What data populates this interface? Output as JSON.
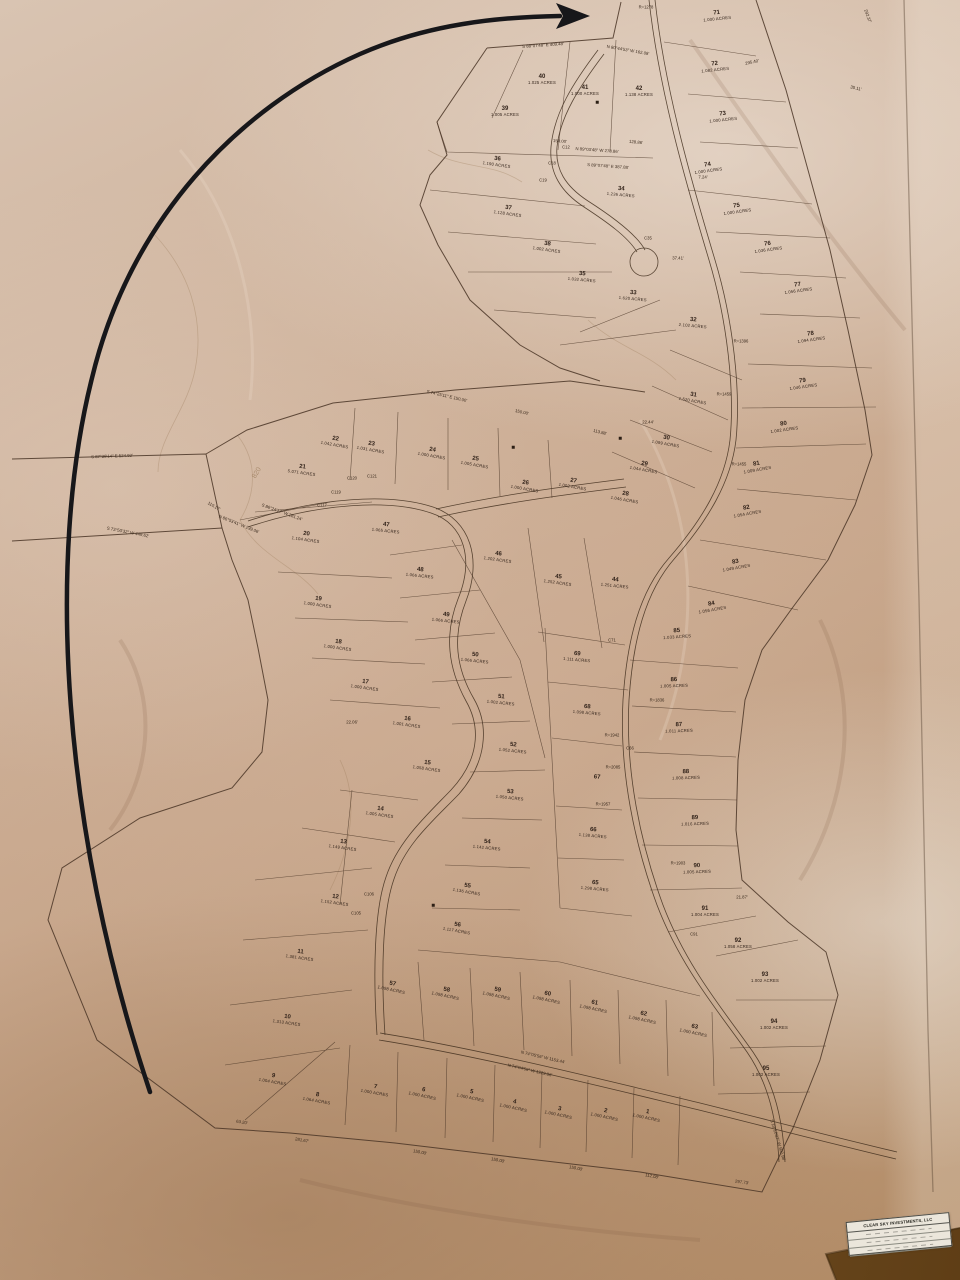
{
  "title_block": {
    "company": "CLEAR SKY INVESTMENTS, LLC",
    "rows": [
      "",
      "",
      ""
    ]
  },
  "colors": {
    "paper": "#cbab90",
    "table_wood": "#6d4a22",
    "plat_ink": "#3a2a1d",
    "hand_arrow": "#17171a"
  },
  "lots": [
    {
      "n": "1",
      "a": "1.000 ACRES",
      "x": 647,
      "y": 1115,
      "r": 12
    },
    {
      "n": "2",
      "a": "1.000 ACRES",
      "x": 605,
      "y": 1114,
      "r": 12
    },
    {
      "n": "3",
      "a": "1.000 ACRES",
      "x": 559,
      "y": 1112,
      "r": 12
    },
    {
      "n": "4",
      "a": "1.000 ACRES",
      "x": 514,
      "y": 1105,
      "r": 12
    },
    {
      "n": "5",
      "a": "1.000 ACRES",
      "x": 471,
      "y": 1095,
      "r": 12
    },
    {
      "n": "6",
      "a": "1.000 ACRES",
      "x": 423,
      "y": 1093,
      "r": 12
    },
    {
      "n": "7",
      "a": "1.000 ACRES",
      "x": 375,
      "y": 1090,
      "r": 10
    },
    {
      "n": "8",
      "a": "1.064 ACRES",
      "x": 317,
      "y": 1098,
      "r": 10
    },
    {
      "n": "9",
      "a": "1.004 ACRES",
      "x": 273,
      "y": 1079,
      "r": 10
    },
    {
      "n": "10",
      "a": "1.313 ACRES",
      "x": 287,
      "y": 1020,
      "r": 8
    },
    {
      "n": "11",
      "a": "1.381 ACRES",
      "x": 300,
      "y": 955,
      "r": 8
    },
    {
      "n": "12",
      "a": "1.152 ACRES",
      "x": 335,
      "y": 900,
      "r": 8
    },
    {
      "n": "13",
      "a": "1.149 ACRES",
      "x": 343,
      "y": 845,
      "r": 8
    },
    {
      "n": "14",
      "a": "1.005 ACRES",
      "x": 380,
      "y": 812,
      "r": 8
    },
    {
      "n": "15",
      "a": "1.058 ACRES",
      "x": 427,
      "y": 766,
      "r": 8
    },
    {
      "n": "16",
      "a": "1.001 ACRES",
      "x": 407,
      "y": 722,
      "r": 8
    },
    {
      "n": "17",
      "a": "1.000 ACRES",
      "x": 365,
      "y": 685,
      "r": 8
    },
    {
      "n": "18",
      "a": "1.000 ACRES",
      "x": 338,
      "y": 645,
      "r": 8
    },
    {
      "n": "19",
      "a": "1.000 ACRES",
      "x": 318,
      "y": 602,
      "r": 8
    },
    {
      "n": "20",
      "a": "1.104 ACRES",
      "x": 306,
      "y": 537,
      "r": 8
    },
    {
      "n": "21",
      "a": "5.071 ACRES",
      "x": 302,
      "y": 470,
      "r": 8
    },
    {
      "n": "22",
      "a": "1.042 ACRES",
      "x": 335,
      "y": 442,
      "r": 10
    },
    {
      "n": "23",
      "a": "1.031 ACRES",
      "x": 371,
      "y": 447,
      "r": 10
    },
    {
      "n": "24",
      "a": "1.000 ACRES",
      "x": 432,
      "y": 453,
      "r": 10
    },
    {
      "n": "25",
      "a": "1.005 ACRES",
      "x": 475,
      "y": 462,
      "r": 10
    },
    {
      "n": "26",
      "a": "1.000 ACRES",
      "x": 525,
      "y": 486,
      "r": 10
    },
    {
      "n": "27",
      "a": "1.002 ACRES",
      "x": 573,
      "y": 484,
      "r": 10
    },
    {
      "n": "28",
      "a": "1.046 ACRES",
      "x": 625,
      "y": 497,
      "r": 10
    },
    {
      "n": "29",
      "a": "1.044 ACRES",
      "x": 644,
      "y": 467,
      "r": 10
    },
    {
      "n": "30",
      "a": "1.099 ACRES",
      "x": 666,
      "y": 441,
      "r": 10
    },
    {
      "n": "31",
      "a": "1.520 ACRES",
      "x": 693,
      "y": 398,
      "r": 10
    },
    {
      "n": "32",
      "a": "2.102 ACRES",
      "x": 693,
      "y": 323,
      "r": 5
    },
    {
      "n": "33",
      "a": "1.620 ACRES",
      "x": 633,
      "y": 296,
      "r": 5
    },
    {
      "n": "34",
      "a": "1.236 ACRES",
      "x": 621,
      "y": 192,
      "r": 5
    },
    {
      "n": "35",
      "a": "1.032 ACRES",
      "x": 582,
      "y": 277,
      "r": 5
    },
    {
      "n": "36",
      "a": "1.190 ACRES",
      "x": 497,
      "y": 162,
      "r": 8
    },
    {
      "n": "37",
      "a": "1.128 ACRES",
      "x": 508,
      "y": 211,
      "r": 8
    },
    {
      "n": "38",
      "a": "1.002 ACRES",
      "x": 547,
      "y": 247,
      "r": 8
    },
    {
      "n": "39",
      "a": "1.005 ACRES",
      "x": 505,
      "y": 112,
      "r": 0
    },
    {
      "n": "40",
      "a": "1.025 ACRES",
      "x": 542,
      "y": 80,
      "r": 0
    },
    {
      "n": "41",
      "a": "1.000 ACRES",
      "x": 585,
      "y": 91,
      "r": 0
    },
    {
      "n": "42",
      "a": "1.138 ACRES",
      "x": 639,
      "y": 92,
      "r": 0
    },
    {
      "n": "44",
      "a": "1.251 ACRES",
      "x": 615,
      "y": 583,
      "r": 6
    },
    {
      "n": "45",
      "a": "1.252 ACRES",
      "x": 558,
      "y": 580,
      "r": 8
    },
    {
      "n": "46",
      "a": "1.202 ACRES",
      "x": 498,
      "y": 557,
      "r": 8
    },
    {
      "n": "47",
      "a": "1.065 ACRES",
      "x": 386,
      "y": 528,
      "r": 6
    },
    {
      "n": "48",
      "a": "1.066 ACRES",
      "x": 420,
      "y": 573,
      "r": 6
    },
    {
      "n": "49",
      "a": "1.066 ACRES",
      "x": 446,
      "y": 618,
      "r": 6
    },
    {
      "n": "50",
      "a": "1.066 ACRES",
      "x": 475,
      "y": 658,
      "r": 6
    },
    {
      "n": "51",
      "a": "1.002 ACRES",
      "x": 501,
      "y": 700,
      "r": 6
    },
    {
      "n": "52",
      "a": "1.052 ACRES",
      "x": 513,
      "y": 748,
      "r": 6
    },
    {
      "n": "53",
      "a": "1.050 ACRES",
      "x": 510,
      "y": 795,
      "r": 6
    },
    {
      "n": "54",
      "a": "1.142 ACRES",
      "x": 487,
      "y": 845,
      "r": 6
    },
    {
      "n": "55",
      "a": "1.136 ACRES",
      "x": 467,
      "y": 889,
      "r": 10
    },
    {
      "n": "56",
      "a": "1.117 ACRES",
      "x": 457,
      "y": 928,
      "r": 10
    },
    {
      "n": "57",
      "a": "1.098 ACRES",
      "x": 392,
      "y": 987,
      "r": 12
    },
    {
      "n": "58",
      "a": "1.098 ACRES",
      "x": 446,
      "y": 993,
      "r": 12
    },
    {
      "n": "59",
      "a": "1.098 ACRES",
      "x": 497,
      "y": 993,
      "r": 12
    },
    {
      "n": "60",
      "a": "1.098 ACRES",
      "x": 547,
      "y": 997,
      "r": 12
    },
    {
      "n": "61",
      "a": "1.098 ACRES",
      "x": 594,
      "y": 1006,
      "r": 12
    },
    {
      "n": "62",
      "a": "1.098 ACRES",
      "x": 643,
      "y": 1017,
      "r": 12
    },
    {
      "n": "63",
      "a": "1.000 ACRES",
      "x": 694,
      "y": 1030,
      "r": 12
    },
    {
      "n": "65",
      "a": "1.298 ACRES",
      "x": 595,
      "y": 886,
      "r": 5
    },
    {
      "n": "66",
      "a": "1.138 ACRES",
      "x": 593,
      "y": 833,
      "r": 5
    },
    {
      "n": "67",
      "a": "",
      "x": 597,
      "y": 778,
      "r": 5
    },
    {
      "n": "68",
      "a": "1.098 ACRES",
      "x": 587,
      "y": 710,
      "r": 5
    },
    {
      "n": "69",
      "a": "1.111 ACRES",
      "x": 577,
      "y": 657,
      "r": 5
    },
    {
      "n": "71",
      "a": "1.000 ACRES",
      "x": 717,
      "y": 16,
      "r": -6
    },
    {
      "n": "72",
      "a": "1.082 ACRES",
      "x": 715,
      "y": 67,
      "r": -6
    },
    {
      "n": "73",
      "a": "1.000 ACRES",
      "x": 723,
      "y": 117,
      "r": -6
    },
    {
      "n": "74",
      "a": "1.000 ACRES",
      "x": 708,
      "y": 168,
      "r": -8
    },
    {
      "n": "75",
      "a": "1.000 ACRES",
      "x": 737,
      "y": 209,
      "r": -8
    },
    {
      "n": "76",
      "a": "1.036 ACRES",
      "x": 768,
      "y": 247,
      "r": -8
    },
    {
      "n": "77",
      "a": "1.056 ACRES",
      "x": 798,
      "y": 288,
      "r": -8
    },
    {
      "n": "78",
      "a": "1.094 ACRES",
      "x": 811,
      "y": 337,
      "r": -8
    },
    {
      "n": "79",
      "a": "1.046 ACRES",
      "x": 803,
      "y": 384,
      "r": -8
    },
    {
      "n": "80",
      "a": "1.002 ACRES",
      "x": 784,
      "y": 427,
      "r": -8
    },
    {
      "n": "81",
      "a": "1.009 ACRES",
      "x": 757,
      "y": 467,
      "r": -10
    },
    {
      "n": "82",
      "a": "1.054 ACRES",
      "x": 747,
      "y": 511,
      "r": -10
    },
    {
      "n": "83",
      "a": "1.049 ACRES",
      "x": 736,
      "y": 565,
      "r": -10
    },
    {
      "n": "84",
      "a": "1.056 ACRES",
      "x": 712,
      "y": 607,
      "r": -10
    },
    {
      "n": "85",
      "a": "1.033 ACRES",
      "x": 677,
      "y": 634,
      "r": -4
    },
    {
      "n": "86",
      "a": "1.005 ACRES",
      "x": 674,
      "y": 683,
      "r": -2
    },
    {
      "n": "87",
      "a": "1.011 ACRES",
      "x": 679,
      "y": 728,
      "r": -2
    },
    {
      "n": "88",
      "a": "1.008 ACRES",
      "x": 686,
      "y": 775,
      "r": -2
    },
    {
      "n": "89",
      "a": "1.016 ACRES",
      "x": 695,
      "y": 821,
      "r": -2
    },
    {
      "n": "90",
      "a": "1.005 ACRES",
      "x": 697,
      "y": 869,
      "r": -2
    },
    {
      "n": "91",
      "a": "1.004 ACRES",
      "x": 705,
      "y": 912,
      "r": 0
    },
    {
      "n": "92",
      "a": "1.058 ACRES",
      "x": 738,
      "y": 944,
      "r": 0
    },
    {
      "n": "93",
      "a": "1.002 ACRES",
      "x": 765,
      "y": 978,
      "r": 0
    },
    {
      "n": "94",
      "a": "1.002 ACRES",
      "x": 774,
      "y": 1025,
      "r": 0
    },
    {
      "n": "95",
      "a": "1.002 ACRES",
      "x": 766,
      "y": 1072,
      "r": 0
    }
  ],
  "bearings": [
    {
      "t": "S 88°07'48\" E  409.48'",
      "x": 543,
      "y": 45,
      "r": -4
    },
    {
      "t": "N 80°44'53\" W  162.08'",
      "x": 628,
      "y": 50,
      "r": 10
    },
    {
      "t": "N 89°03'48\" W  278.86'",
      "x": 597,
      "y": 150,
      "r": 4
    },
    {
      "t": "S 89°07'48\" E  387.88'",
      "x": 608,
      "y": 166,
      "r": 4
    },
    {
      "t": "150.00'",
      "x": 560,
      "y": 141,
      "r": 4
    },
    {
      "t": "128.86'",
      "x": 636,
      "y": 142,
      "r": 6
    },
    {
      "t": "S 74°25'11\" E  150.00'",
      "x": 447,
      "y": 396,
      "r": 13
    },
    {
      "t": "150.00'",
      "x": 522,
      "y": 412,
      "r": 13
    },
    {
      "t": "113.88'",
      "x": 600,
      "y": 432,
      "r": 14
    },
    {
      "t": "S 87°38'14\" E  524.92'",
      "x": 112,
      "y": 456,
      "r": -2
    },
    {
      "t": "S 73°50'32\" W  449.62'",
      "x": 128,
      "y": 532,
      "r": 11
    },
    {
      "t": "110.17'",
      "x": 214,
      "y": 506,
      "r": 30
    },
    {
      "t": "N 86°53'41\" W  239.06'",
      "x": 239,
      "y": 524,
      "r": 22
    },
    {
      "t": "S 86°24'17\" W  281.24'",
      "x": 282,
      "y": 512,
      "r": 20
    },
    {
      "t": "N 74°05'56\" W  1153.44'",
      "x": 543,
      "y": 1057,
      "r": 13
    },
    {
      "t": "N 74°04'56\" W  1229.86'",
      "x": 530,
      "y": 1070,
      "r": 13
    },
    {
      "t": "S 10°10'27\" W  502.98'",
      "x": 778,
      "y": 1140,
      "r": 73
    },
    {
      "t": "63.20'",
      "x": 242,
      "y": 1122,
      "r": 10
    },
    {
      "t": "281.67'",
      "x": 302,
      "y": 1140,
      "r": 10
    },
    {
      "t": "150.00'",
      "x": 420,
      "y": 1152,
      "r": 11
    },
    {
      "t": "150.00'",
      "x": 498,
      "y": 1160,
      "r": 11
    },
    {
      "t": "150.00'",
      "x": 576,
      "y": 1168,
      "r": 11
    },
    {
      "t": "112.08'",
      "x": 652,
      "y": 1176,
      "r": 11
    },
    {
      "t": "297.73'",
      "x": 742,
      "y": 1182,
      "r": 8
    },
    {
      "t": "292.37'",
      "x": 868,
      "y": 16,
      "r": 70
    },
    {
      "t": "295.40'",
      "x": 752,
      "y": 62,
      "r": -12
    },
    {
      "t": "35.11'",
      "x": 856,
      "y": 88,
      "r": 12
    },
    {
      "t": "37.41'",
      "x": 678,
      "y": 258,
      "r": 0
    },
    {
      "t": "7.24'",
      "x": 703,
      "y": 177,
      "r": 0
    },
    {
      "t": "22.44'",
      "x": 648,
      "y": 422,
      "r": 0
    },
    {
      "t": "22.06'",
      "x": 352,
      "y": 722,
      "r": 0
    },
    {
      "t": "21.87'",
      "x": 742,
      "y": 897,
      "r": 0
    }
  ],
  "curve_labels": [
    {
      "t": "R=1278",
      "x": 646,
      "y": 7
    },
    {
      "t": "R=1396",
      "x": 741,
      "y": 341
    },
    {
      "t": "R=1459",
      "x": 724,
      "y": 394
    },
    {
      "t": "R=1455",
      "x": 739,
      "y": 464
    },
    {
      "t": "R=1836",
      "x": 657,
      "y": 700
    },
    {
      "t": "R=1942",
      "x": 612,
      "y": 735
    },
    {
      "t": "R=2085",
      "x": 613,
      "y": 767
    },
    {
      "t": "R=1957",
      "x": 603,
      "y": 804
    },
    {
      "t": "R=1903",
      "x": 678,
      "y": 863
    },
    {
      "t": "C12",
      "x": 566,
      "y": 147
    },
    {
      "t": "C18",
      "x": 552,
      "y": 163
    },
    {
      "t": "C19",
      "x": 543,
      "y": 180
    },
    {
      "t": "C35",
      "x": 648,
      "y": 238
    },
    {
      "t": "C117",
      "x": 322,
      "y": 505
    },
    {
      "t": "C119",
      "x": 336,
      "y": 492
    },
    {
      "t": "C120",
      "x": 352,
      "y": 478
    },
    {
      "t": "C121",
      "x": 372,
      "y": 476
    },
    {
      "t": "C71",
      "x": 612,
      "y": 640
    },
    {
      "t": "C66",
      "x": 630,
      "y": 748
    },
    {
      "t": "C91",
      "x": 694,
      "y": 934
    },
    {
      "t": "C105",
      "x": 356,
      "y": 913
    },
    {
      "t": "C106",
      "x": 369,
      "y": 894
    }
  ],
  "contour_labels": [
    {
      "t": "820",
      "x": 257,
      "y": 473
    }
  ],
  "markers": [
    {
      "x": 597,
      "y": 102
    },
    {
      "x": 513,
      "y": 447
    },
    {
      "x": 620,
      "y": 438
    },
    {
      "x": 433,
      "y": 905
    }
  ]
}
